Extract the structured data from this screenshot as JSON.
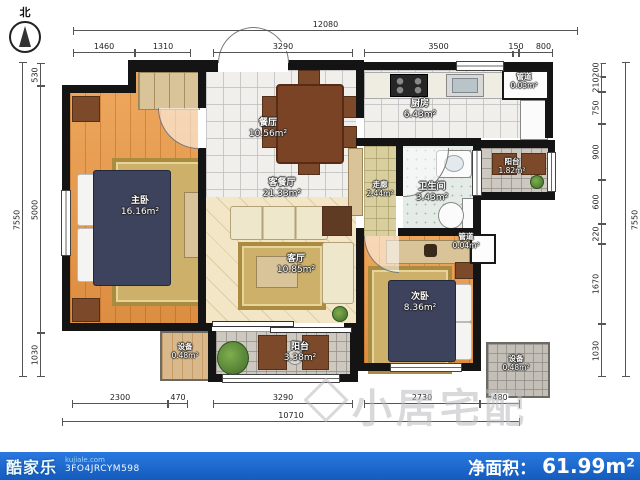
{
  "compass": {
    "north_label": "北"
  },
  "watermark": {
    "text": "小居宅配"
  },
  "footer": {
    "brand": "酷家乐",
    "site": "kujiale.com",
    "code": "3FO4JRCYM598",
    "net_area_label": "净面积：",
    "net_area_value": "61.99m²"
  },
  "rooms": {
    "master": {
      "name": "主卧",
      "area": "16.16m²"
    },
    "dining": {
      "name": "餐厅",
      "area": "10.56m²"
    },
    "living_dining": {
      "name": "客餐厅",
      "area": "21.33m²"
    },
    "living": {
      "name": "客厅",
      "area": "10.85m²"
    },
    "kitchen": {
      "name": "厨房",
      "area": "6.43m²"
    },
    "corridor": {
      "name": "走廊",
      "area": "2.44m²"
    },
    "bathroom": {
      "name": "卫生间",
      "area": "3.43m²"
    },
    "bedroom2": {
      "name": "次卧",
      "area": "8.36m²"
    },
    "balcony_right": {
      "name": "阳台",
      "area": "1.82m²"
    },
    "balcony_bottom": {
      "name": "阳台",
      "area": "3.38m²"
    },
    "equip_left": {
      "name": "设备",
      "area": "0.48m²"
    },
    "equip_right": {
      "name": "设备",
      "area": "0.48m²"
    },
    "duct_top": {
      "name": "管道",
      "area": "0.03m²"
    },
    "duct_mid": {
      "name": "管道",
      "area": "0.04m²"
    }
  },
  "dimensions": {
    "top_total": "12080",
    "top": [
      "1460",
      "1310",
      "3290",
      "3500",
      "150",
      "800"
    ],
    "bottom": [
      "2300",
      "470",
      "3290",
      "2730",
      "480"
    ],
    "bottom_total": "10710",
    "left": [
      "530",
      "5000",
      "1030"
    ],
    "left_total": "7550",
    "right": [
      "200",
      "210",
      "750",
      "900",
      "600",
      "220",
      "1670",
      "1030"
    ],
    "right_total": "7550"
  }
}
